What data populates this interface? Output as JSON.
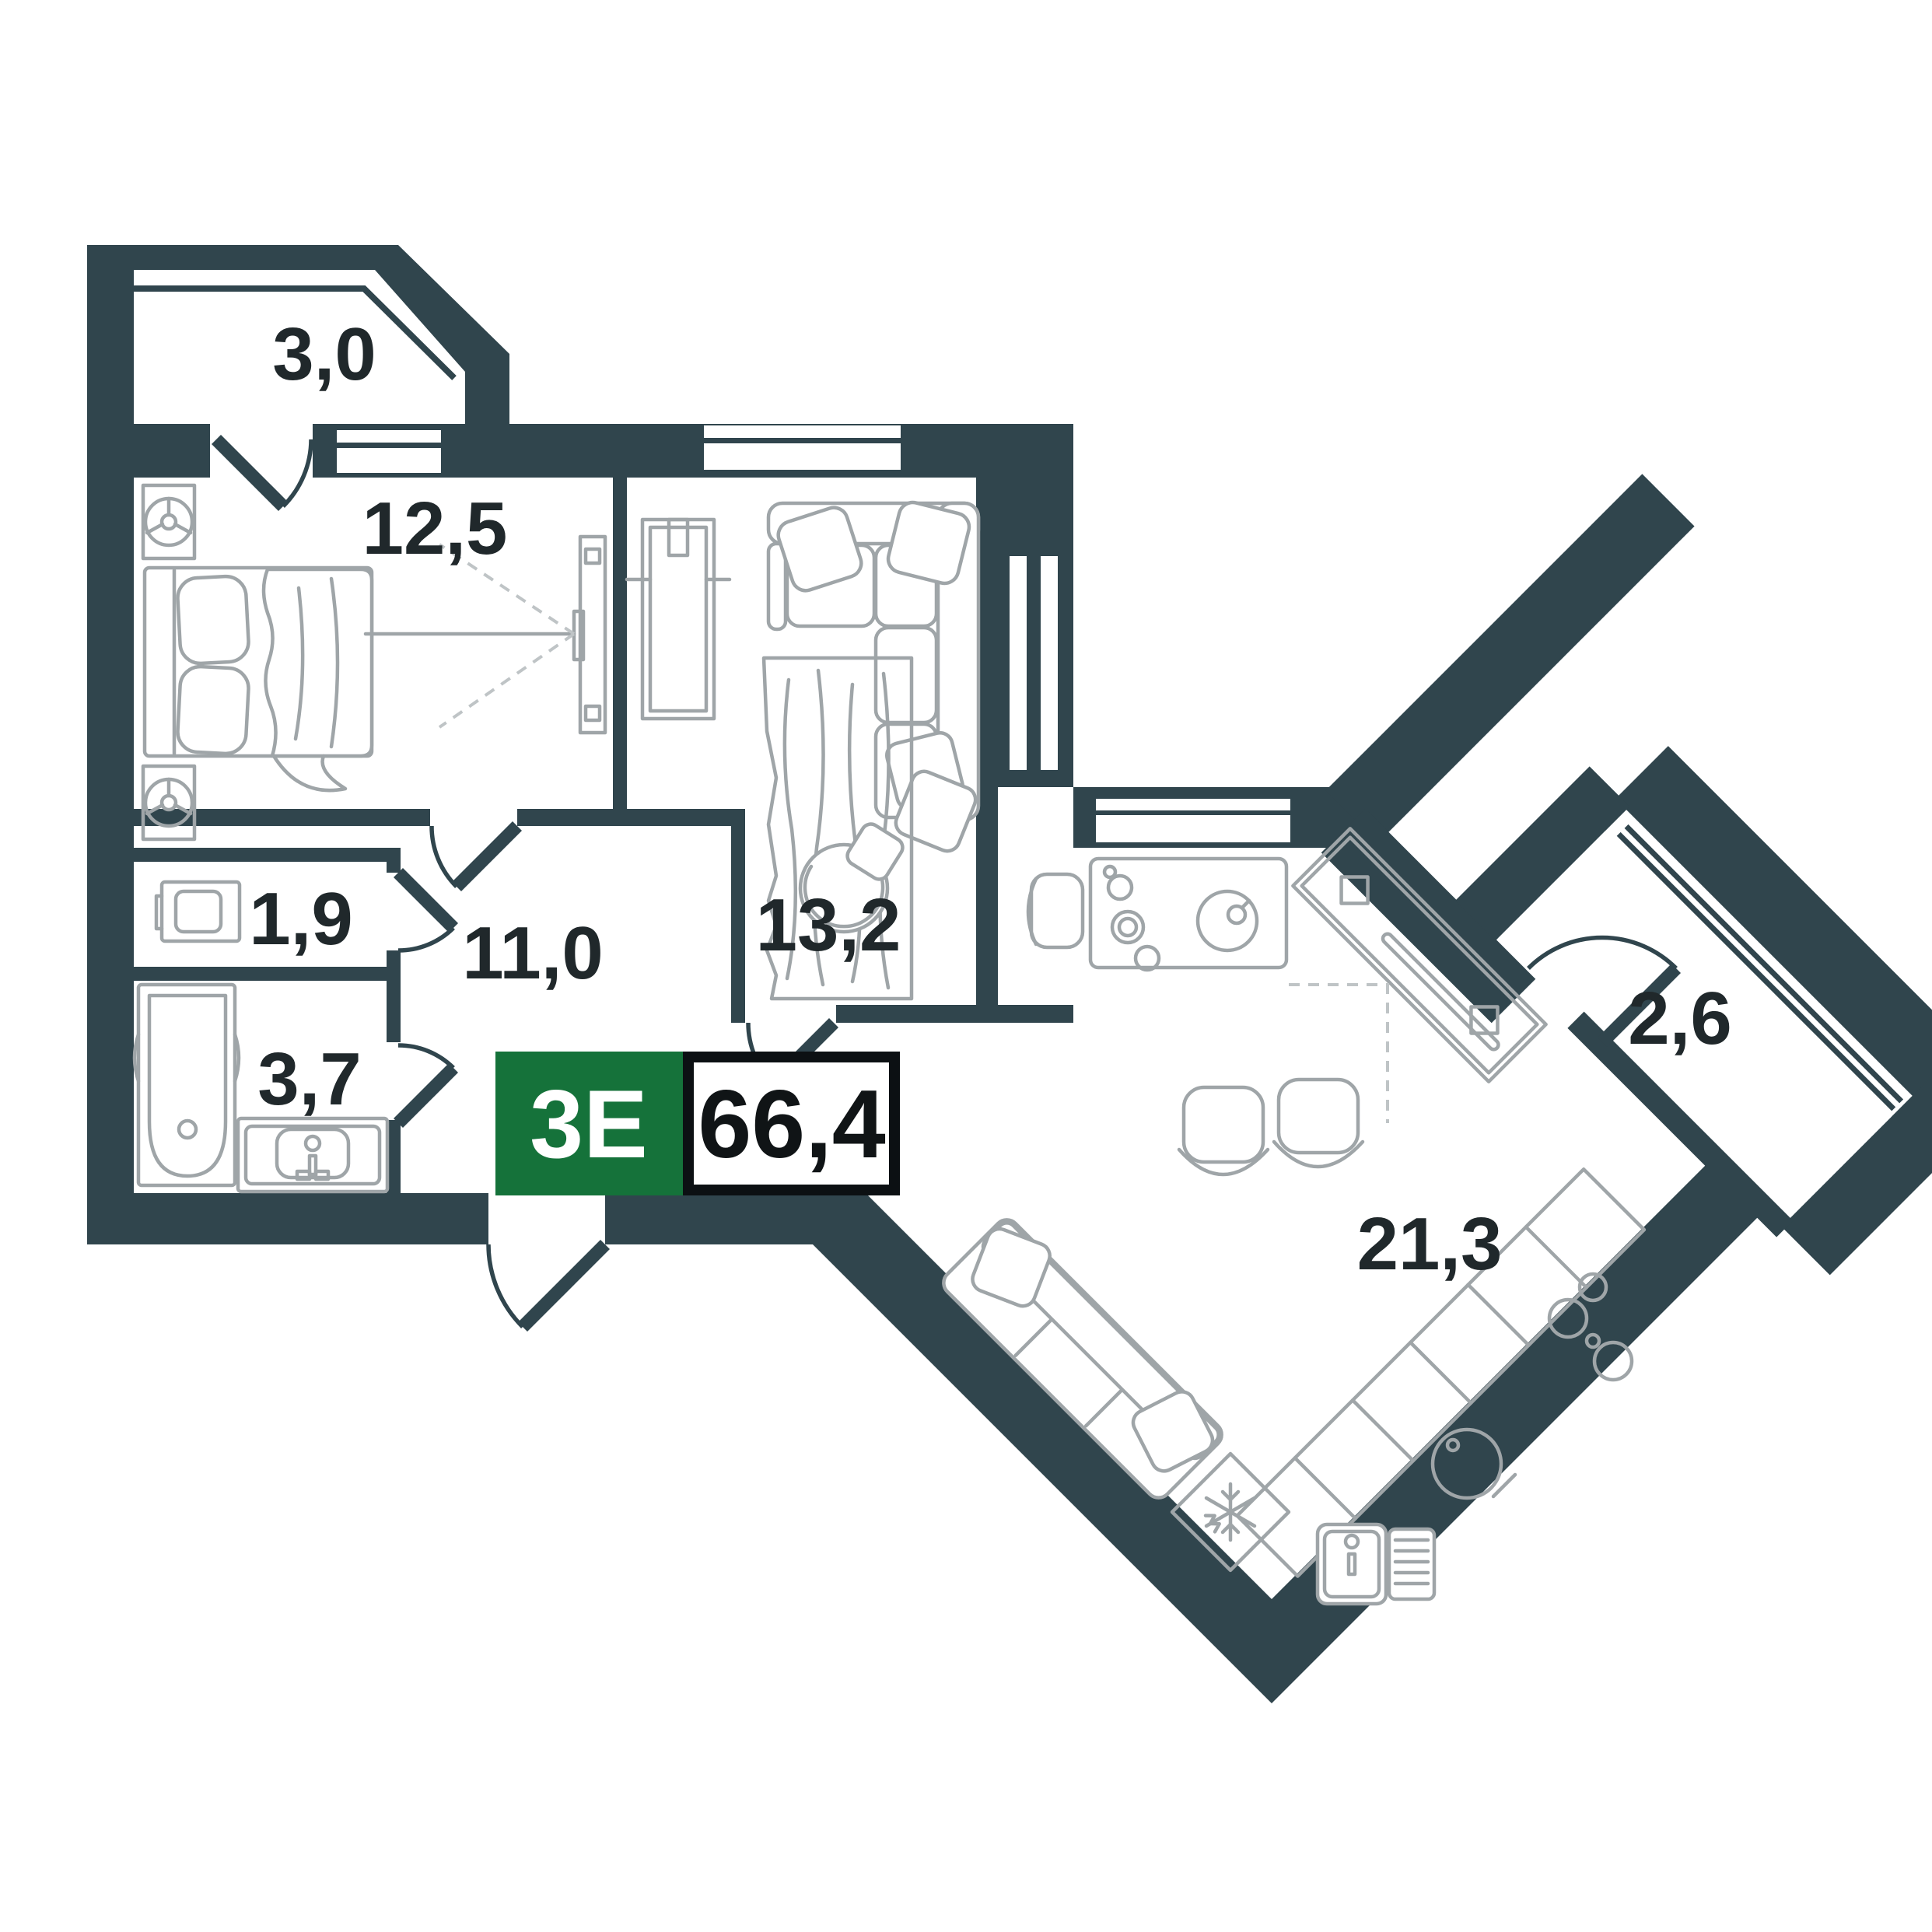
{
  "plan": {
    "type_badge": "3Е",
    "total_area": "66,4",
    "rooms": [
      {
        "id": "balcony-left",
        "label": "3,0"
      },
      {
        "id": "bedroom",
        "label": "12,5"
      },
      {
        "id": "living-room",
        "label": "13,2"
      },
      {
        "id": "wc",
        "label": "1,9"
      },
      {
        "id": "hallway",
        "label": "11,0"
      },
      {
        "id": "bathroom",
        "label": "3,7"
      },
      {
        "id": "balcony-right",
        "label": "2,6"
      },
      {
        "id": "kitchen-living",
        "label": "21,3"
      }
    ],
    "colors": {
      "wall": "#30454D",
      "furniture": "#9FA5A8",
      "dash": "#BFC4C6",
      "badge_green": "#15723A",
      "badge_text": "#FFFFFF",
      "area_text": "#101416",
      "area_border": "#0C1013",
      "label_text": "#20282B",
      "background": "#FFFFFF"
    }
  }
}
